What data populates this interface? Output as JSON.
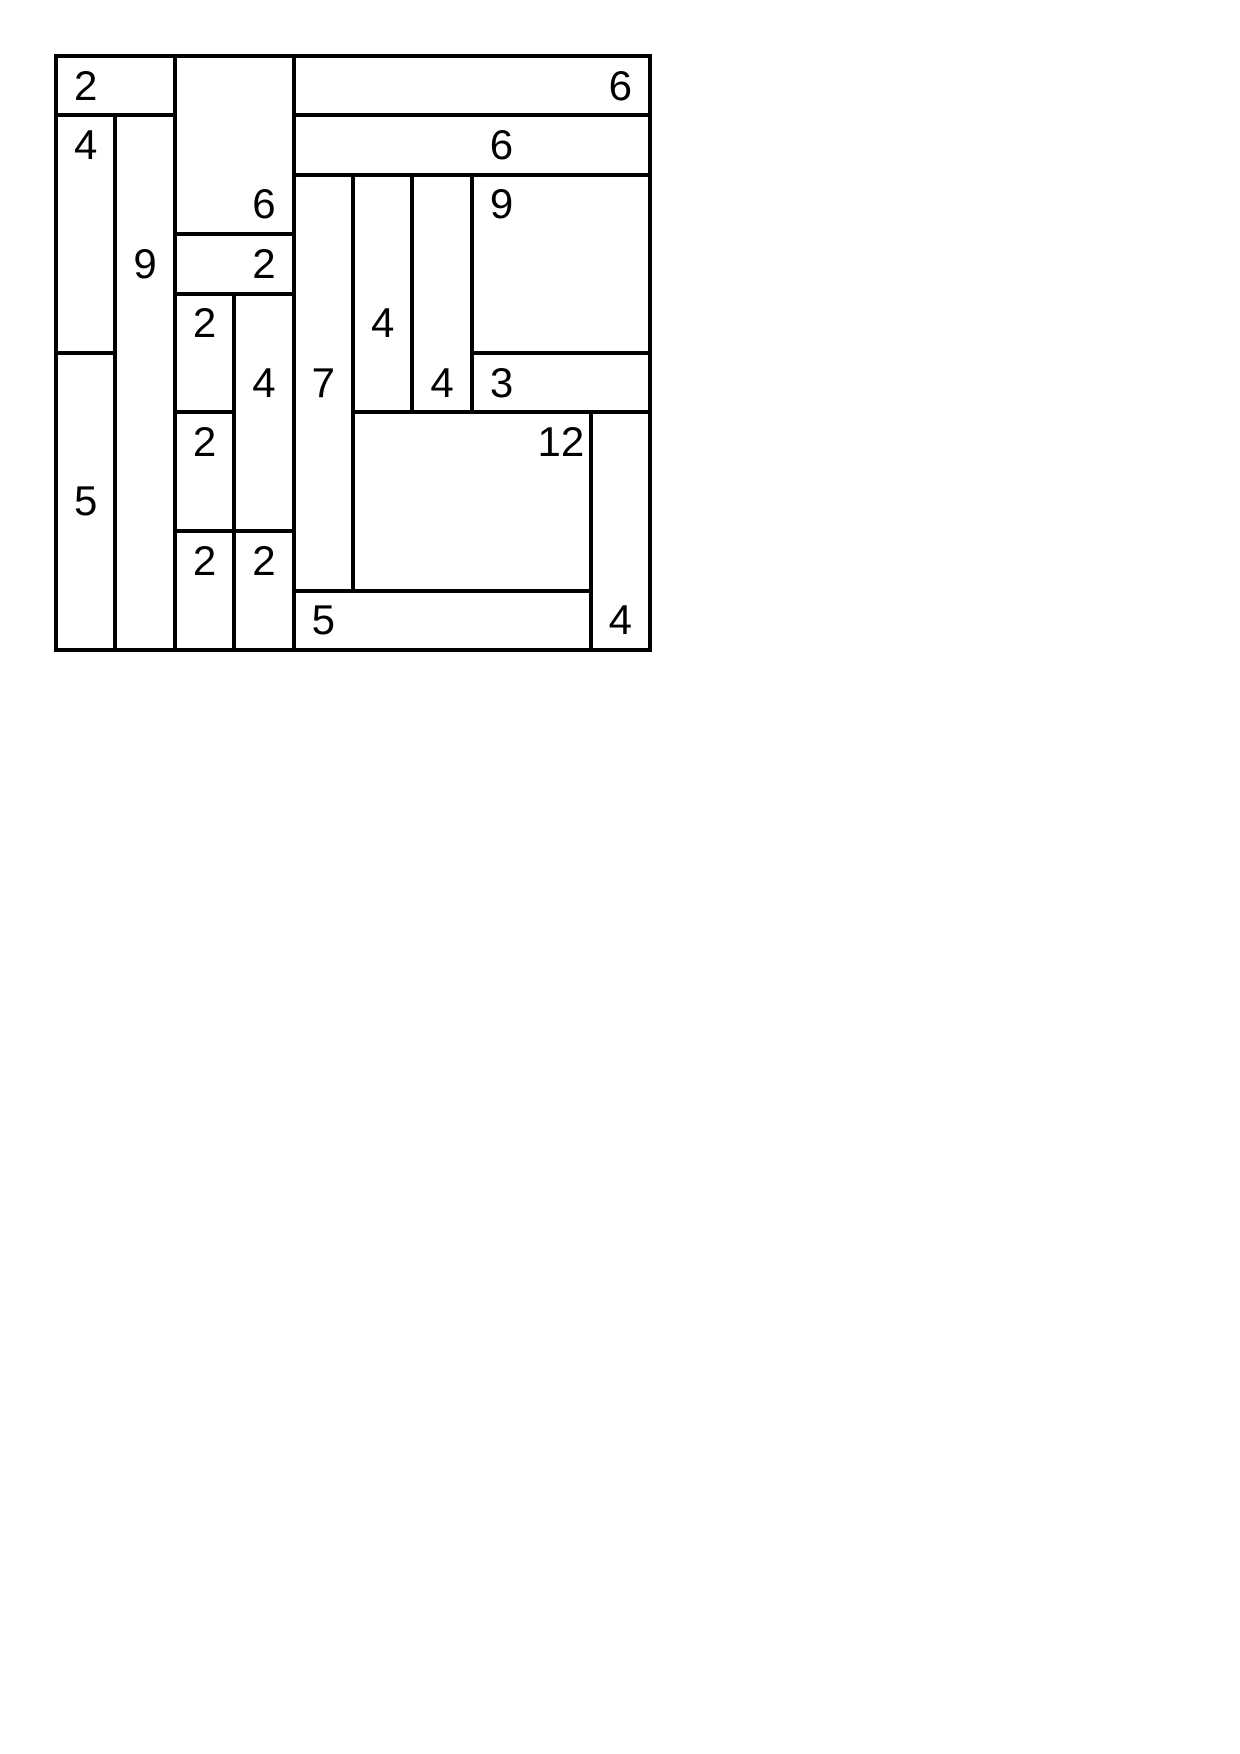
{
  "page": {
    "background_color": "#ffffff"
  },
  "puzzle": {
    "kind": "shikaku-rectangle-grid",
    "grid": {
      "cols": 10,
      "rows": 10,
      "cell_px": 59.4,
      "origin_x_px": 56,
      "origin_y_px": 56,
      "line_color": "#000000",
      "line_thickness_px": 4,
      "cell_background": "#ffffff",
      "number_color": "#000000",
      "number_font_px": 42
    },
    "regions": [
      {
        "x": 0,
        "y": 0,
        "w": 2,
        "h": 1,
        "value": "2",
        "label_col": 0,
        "label_row": 0
      },
      {
        "x": 2,
        "y": 0,
        "w": 2,
        "h": 3,
        "value": "6",
        "label_col": 3,
        "label_row": 2
      },
      {
        "x": 4,
        "y": 0,
        "w": 6,
        "h": 1,
        "value": "6",
        "label_col": 9,
        "label_row": 0
      },
      {
        "x": 0,
        "y": 1,
        "w": 1,
        "h": 4,
        "value": "4",
        "label_col": 0,
        "label_row": 1
      },
      {
        "x": 1,
        "y": 1,
        "w": 1,
        "h": 9,
        "value": "9",
        "label_col": 1,
        "label_row": 3
      },
      {
        "x": 4,
        "y": 1,
        "w": 6,
        "h": 1,
        "value": "6",
        "label_col": 7,
        "label_row": 1
      },
      {
        "x": 7,
        "y": 2,
        "w": 3,
        "h": 3,
        "value": "9",
        "label_col": 7,
        "label_row": 2
      },
      {
        "x": 2,
        "y": 3,
        "w": 2,
        "h": 1,
        "value": "2",
        "label_col": 3,
        "label_row": 3
      },
      {
        "x": 2,
        "y": 4,
        "w": 1,
        "h": 2,
        "value": "2",
        "label_col": 2,
        "label_row": 4
      },
      {
        "x": 3,
        "y": 4,
        "w": 1,
        "h": 4,
        "value": "4",
        "label_col": 3,
        "label_row": 5
      },
      {
        "x": 4,
        "y": 2,
        "w": 1,
        "h": 7,
        "value": "7",
        "label_col": 4,
        "label_row": 5
      },
      {
        "x": 5,
        "y": 2,
        "w": 1,
        "h": 4,
        "value": "4",
        "label_col": 5,
        "label_row": 4
      },
      {
        "x": 6,
        "y": 2,
        "w": 1,
        "h": 4,
        "value": "4",
        "label_col": 6,
        "label_row": 5
      },
      {
        "x": 7,
        "y": 5,
        "w": 3,
        "h": 1,
        "value": "3",
        "label_col": 7,
        "label_row": 5
      },
      {
        "x": 5,
        "y": 6,
        "w": 4,
        "h": 3,
        "value": "12",
        "label_col": 8,
        "label_row": 6
      },
      {
        "x": 9,
        "y": 6,
        "w": 1,
        "h": 4,
        "value": "4",
        "label_col": 9,
        "label_row": 9
      },
      {
        "x": 0,
        "y": 5,
        "w": 1,
        "h": 5,
        "value": "5",
        "label_col": 0,
        "label_row": 7
      },
      {
        "x": 2,
        "y": 6,
        "w": 1,
        "h": 2,
        "value": "2",
        "label_col": 2,
        "label_row": 6
      },
      {
        "x": 2,
        "y": 8,
        "w": 1,
        "h": 2,
        "value": "2",
        "label_col": 2,
        "label_row": 8
      },
      {
        "x": 3,
        "y": 8,
        "w": 1,
        "h": 2,
        "value": "2",
        "label_col": 3,
        "label_row": 8
      },
      {
        "x": 4,
        "y": 9,
        "w": 5,
        "h": 1,
        "value": "5",
        "label_col": 4,
        "label_row": 9
      }
    ]
  }
}
